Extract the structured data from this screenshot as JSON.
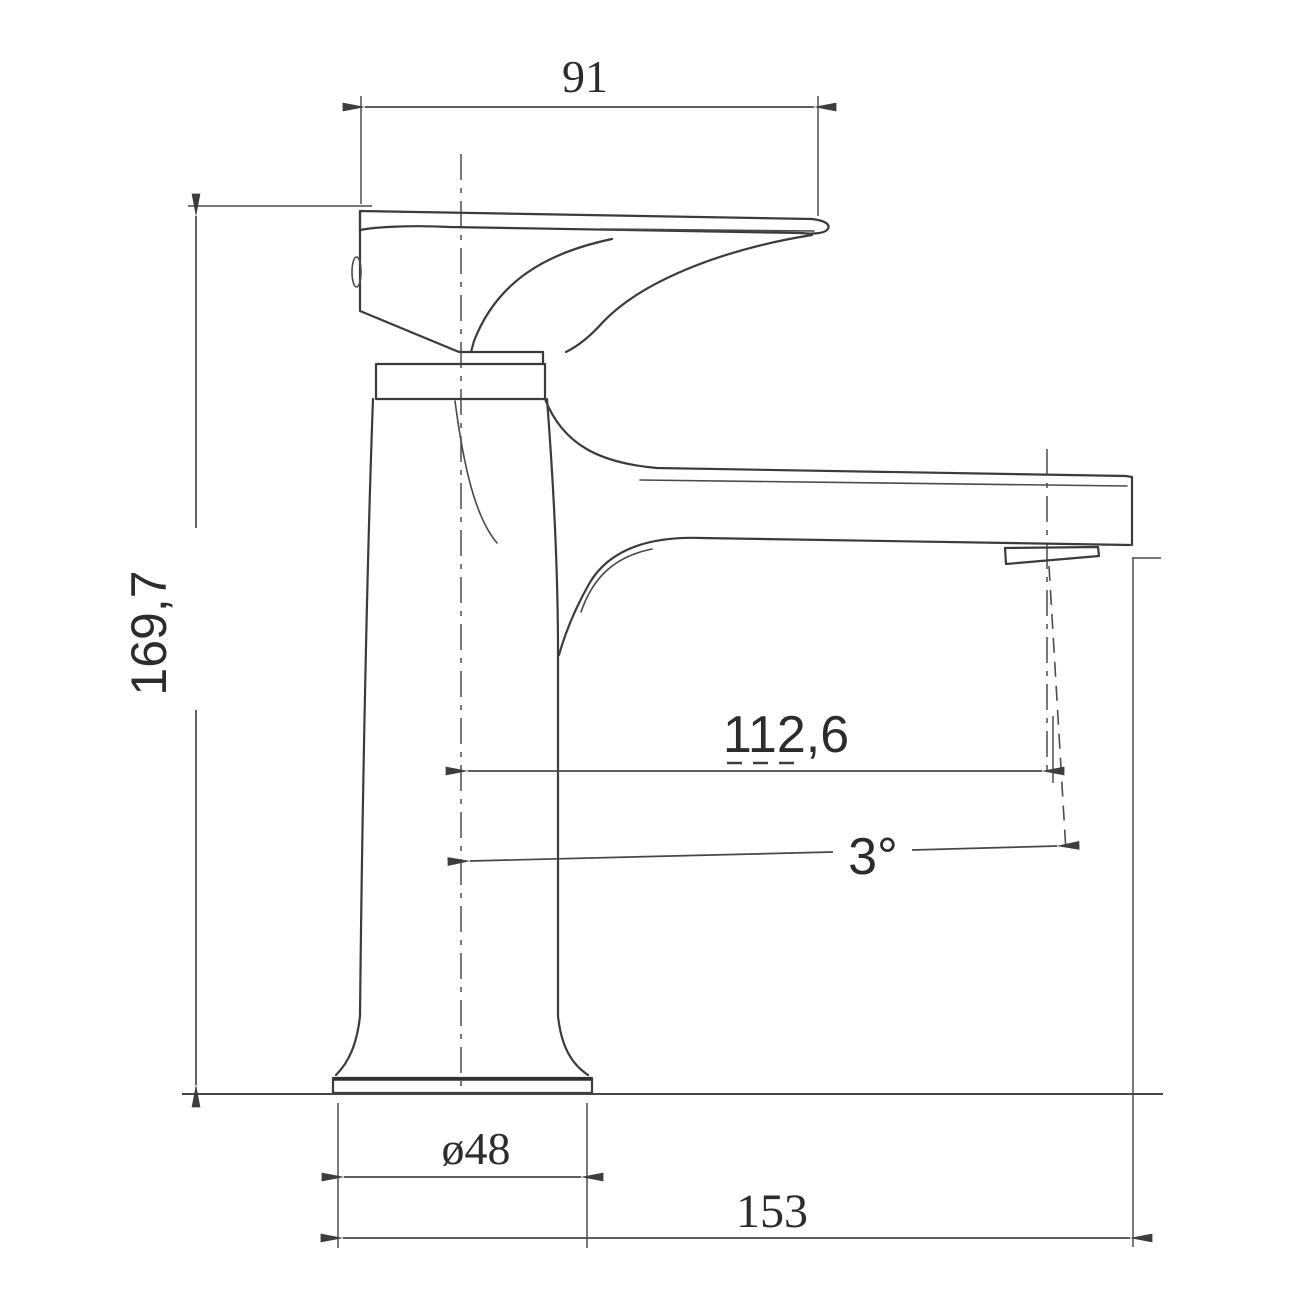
{
  "drawing": {
    "title": "basin mixer tap side elevation technical drawing",
    "background_color": "#ffffff",
    "outline_color": "#3b3b3b",
    "dimension_line_color": "#474747",
    "label_color": "#2c2c2c",
    "dimensions": {
      "handle_width_top": {
        "value": "91",
        "orientation": "horizontal"
      },
      "overall_height": {
        "value": "169,7",
        "orientation": "vertical"
      },
      "spout_reach": {
        "value": "112,6",
        "orientation": "horizontal"
      },
      "spout_angle": {
        "value": "3°",
        "orientation": "angular"
      },
      "base_diameter": {
        "value": "ø48",
        "orientation": "horizontal"
      },
      "overall_depth": {
        "value": "153",
        "orientation": "horizontal"
      }
    }
  }
}
